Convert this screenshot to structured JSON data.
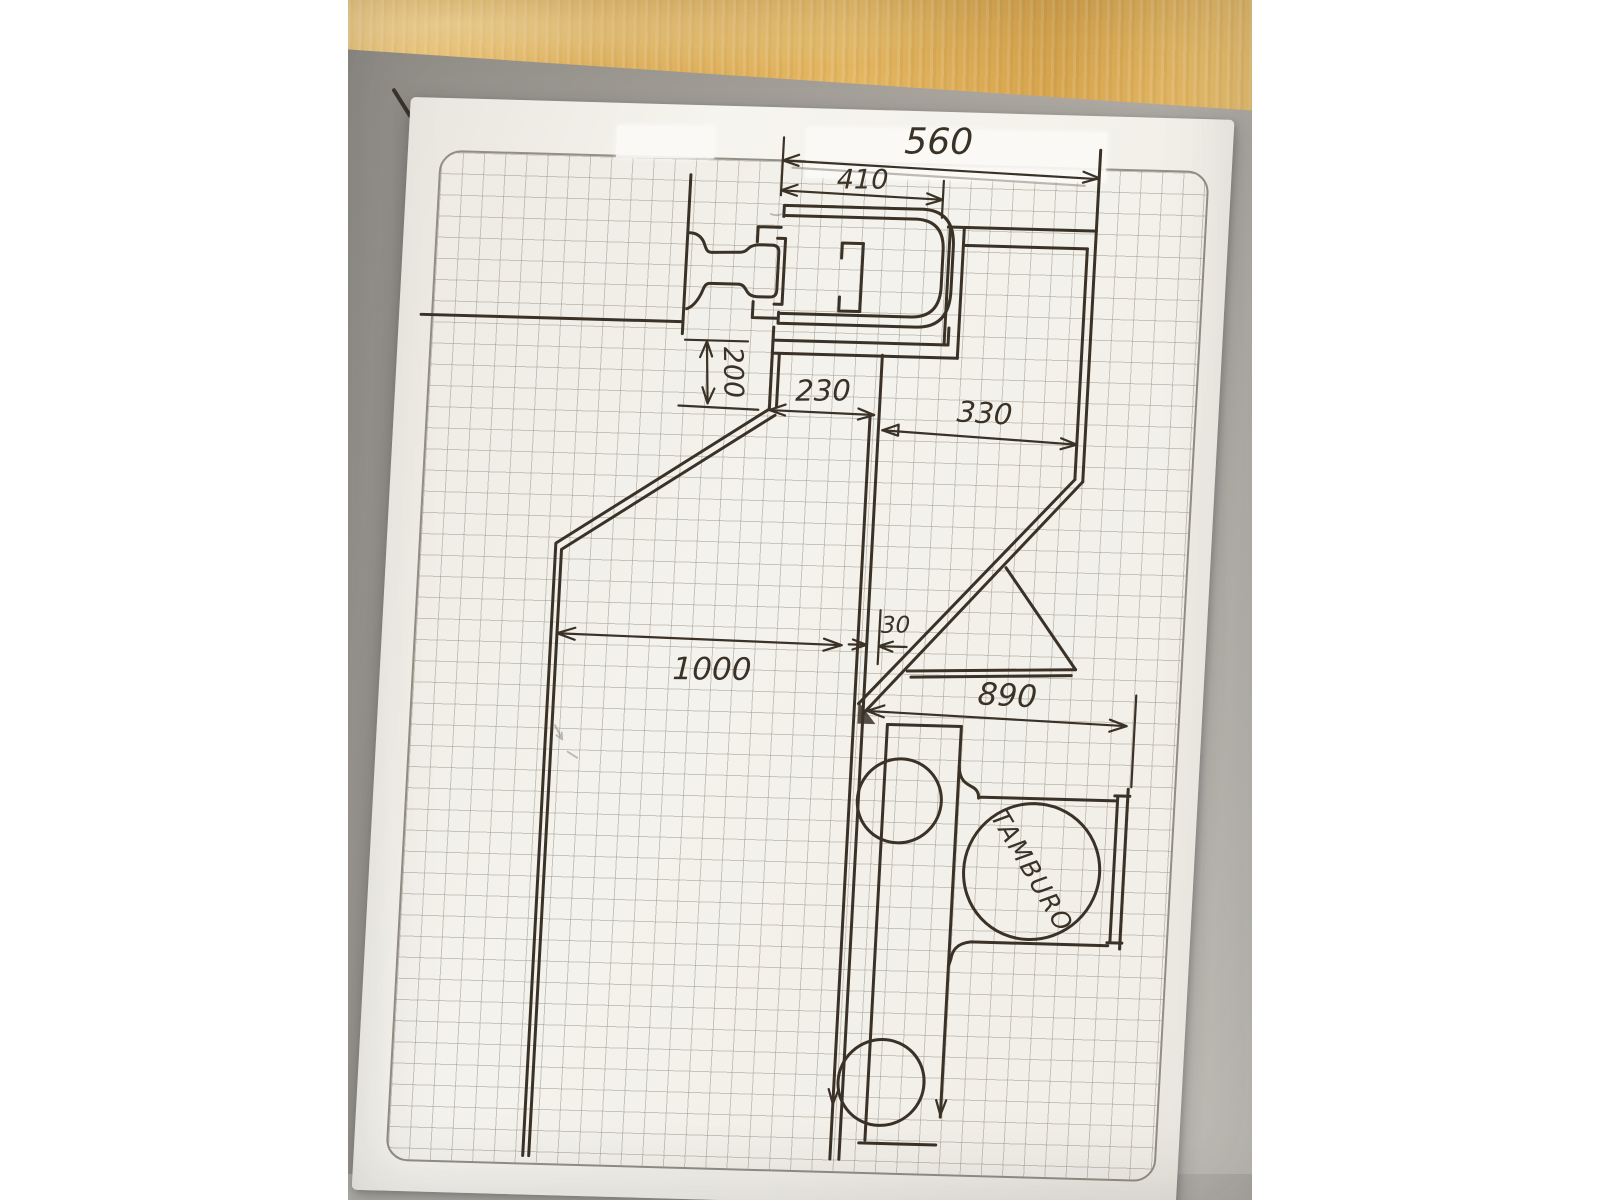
{
  "scene": {
    "type": "photograph of a hand-drawn technical sketch on 5mm graph paper",
    "surfaces": [
      "wooden desk",
      "gray cardboard mat",
      "white graph paper sheet"
    ]
  },
  "colors": {
    "ink": "#3a3127",
    "paper": "#f3f1ea",
    "grid_line": "#948e82",
    "cardboard_mat": "#a8a49d",
    "wood_desk": "#ddab55",
    "letterbox": "#ffffff",
    "correction_tape": "#fbfaf6"
  },
  "drawing": {
    "dimension_labels": {
      "overall_top_width": "560",
      "track_channel_width": "410",
      "wall_offset_height": "200",
      "left_gap": "230",
      "right_gap": "330",
      "small_gap": "30",
      "left_run": "1000",
      "right_run": "890"
    },
    "annotations": {
      "drum_label": "TAMBURO"
    },
    "features": [
      "wall anchor mushroom profile",
      "U-shaped sliding track channel",
      "roller-shutter box outline",
      "double-line partition walls",
      "drum circle with two roller circles",
      "hand-drawn dimension arrows"
    ]
  }
}
